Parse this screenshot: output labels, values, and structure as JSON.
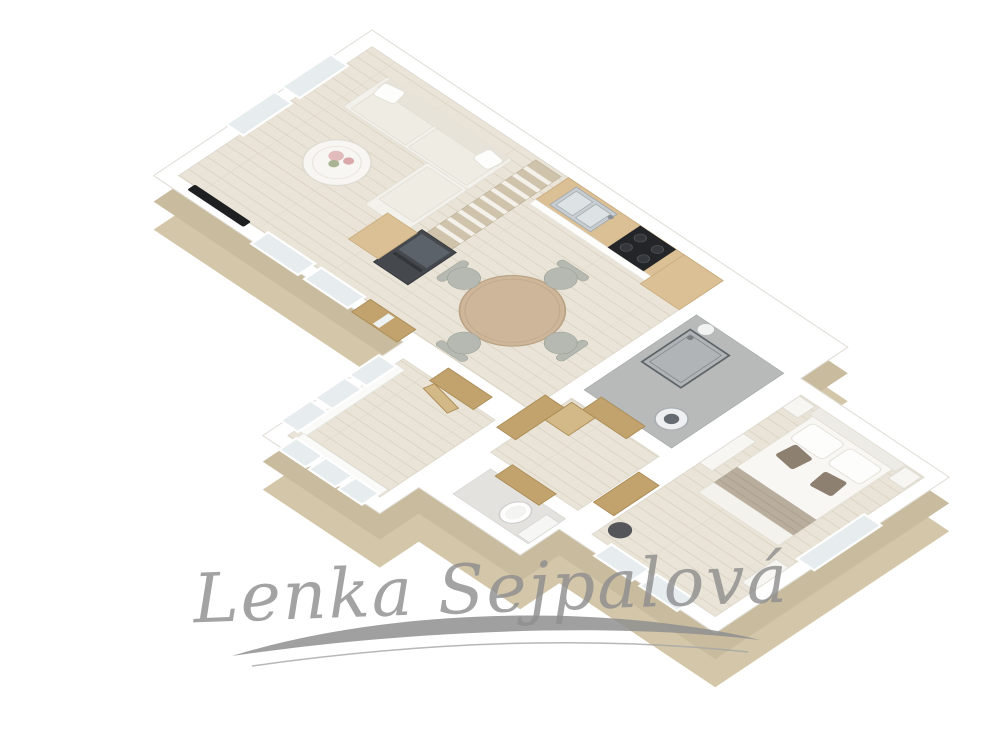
{
  "watermark": {
    "text": "Lenka Sejpalová"
  },
  "scene": {
    "type": "3d-floor-plan-render",
    "projection": "isometric",
    "rooms": [
      {
        "name": "living-room",
        "furniture": [
          "corner-sofa",
          "coffee-table-with-flowers",
          "bookshelf-divider",
          "wall-tv",
          "double-window"
        ]
      },
      {
        "name": "kitchen-dining",
        "furniture": [
          "kitchen-counter",
          "double-sink",
          "cooktop",
          "oven-cabinet",
          "refrigerator",
          "cabinet",
          "round-dining-table",
          "four-chairs",
          "windows",
          "entrance-door"
        ]
      },
      {
        "name": "shower-room",
        "furniture": [
          "glass-shower-cabin",
          "washing-machine",
          "round-basin"
        ]
      },
      {
        "name": "hallway",
        "furniture": [
          "wooden-doors",
          "hall-cabinet"
        ]
      },
      {
        "name": "wc",
        "furniture": [
          "toilet"
        ]
      },
      {
        "name": "bedroom",
        "furniture": [
          "double-bed",
          "pillows",
          "accent-pillows",
          "bed-runner",
          "nightstand-left",
          "nightstand-right",
          "dresser",
          "pouf",
          "windows"
        ]
      },
      {
        "name": "small-room",
        "furniture": [
          "windows",
          "radiators",
          "door"
        ]
      }
    ]
  },
  "palette": {
    "bg": "#ffffff",
    "exteriorWall": "#d3c6a9",
    "exteriorWallDeep": "#c8bb9e",
    "wallTop": "#ffffff",
    "wallStroke": "#e0ddd6",
    "floorWood": "#e9e4d7",
    "floorLine": "#dbd4c3",
    "floorGray": "#b7bab9",
    "wcFloor": "#e3e2de",
    "counterWood": "#dcc095",
    "counterEdge": "#c9ad7f",
    "doorWood": "#c2a26d",
    "doorWoodLight": "#d4b988",
    "doorWoodDark": "#a98a52",
    "doorGlass": "#eef2f3",
    "applianceDark": "#45494e",
    "applianceLight": "#5c6269",
    "stoveBlack": "#232528",
    "steel": "#c7cdd1",
    "steelDark": "#9fa8ad",
    "sofa": "#f3f1eb",
    "sofaBack": "#e7e3d9",
    "cushion": "#efece4",
    "shelfWood": "#cfc3ac",
    "shelfStripe": "#f4f1ea",
    "tableWood": "#cdb69a",
    "tableEdge": "#b9a182",
    "chairGray": "#b5b9b1",
    "chairEdge": "#999f94",
    "bedWhite": "#f8f7f3",
    "bedEdge": "#e2dfd6",
    "pillowWhite": "#fdfdfb",
    "pillowAccent": "#8e8071",
    "runner": "#b9ae9e",
    "runnerLine": "#a29580",
    "glass": "#e7edef",
    "glassFrame": "#ffffff",
    "showerGlass": "#5d6468",
    "furnWhite": "#f7f6f2",
    "furnEdge": "#dedbd3",
    "tvBlack": "#1d1f21",
    "pouf": "#54565a",
    "flowerPink": "#e2bbbb",
    "flowerPinkDeep": "#d9a8a8",
    "flowerGreen": "#a9b393",
    "watermark": "#8f8f8f",
    "watermarkLight": "#a5a5a5"
  }
}
